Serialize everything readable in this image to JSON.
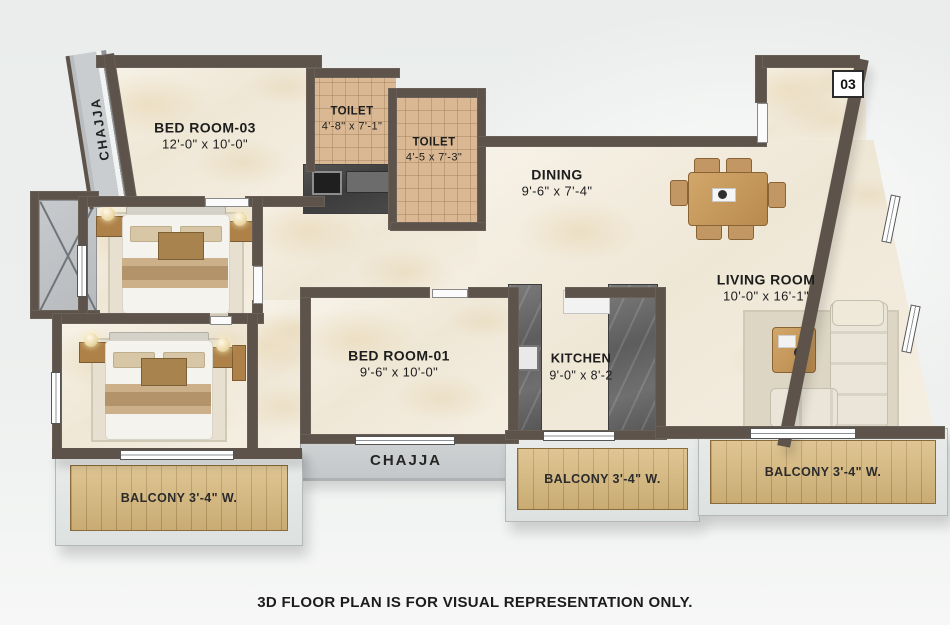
{
  "unit_badge": "03",
  "caption": "3D FLOOR PLAN IS FOR VISUAL REPRESENTATION ONLY.",
  "rooms": {
    "bedroom3": {
      "name": "BED ROOM-03",
      "dims": "12'-0\" x 10'-0\""
    },
    "toilet1": {
      "name": "TOILET",
      "dims": "4'-8\" x 7'-1\""
    },
    "toilet2": {
      "name": "TOILET",
      "dims": "4'-5 x 7'-3\""
    },
    "dining": {
      "name": "DINING",
      "dims": "9'-6\" x 7'-4\""
    },
    "living": {
      "name": "LIVING ROOM",
      "dims": "10'-0\" x 16'-1\""
    },
    "bedroom1": {
      "name": "BED ROOM-01",
      "dims": "9'-6\" x 10'-0\""
    },
    "kitchen": {
      "name": "KITCHEN",
      "dims": "9'-0\" x 8'-2"
    }
  },
  "ledges": {
    "chajja_left": "CHAJJA",
    "chajja_bottom": "CHAJJA"
  },
  "balconies": {
    "left": "BALCONY 3'-4\" W.",
    "middle": "BALCONY 3'-4\" W.",
    "right": "BALCONY 3'-4\" W."
  },
  "colors": {
    "wall": "#5d534b",
    "marble_floor": "#f3ecdf",
    "toilet_tile": "#d9b893",
    "balcony_wood": "#d8b97c",
    "ledge_gray": "#c9cdcf",
    "kitchen_counter": "#666666",
    "furniture_wood": "#b98f54"
  }
}
